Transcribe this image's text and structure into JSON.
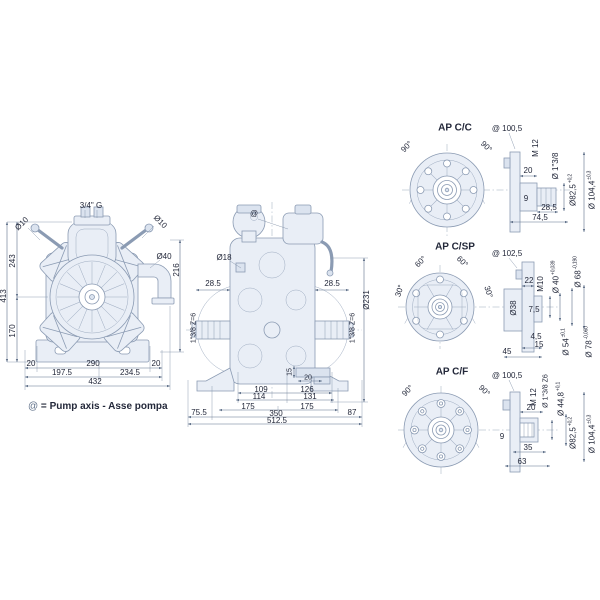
{
  "colors": {
    "line": "#8b9bb3",
    "dim": "#5f7089",
    "fill": "#e9eef6",
    "text": "#23283a"
  },
  "legend": {
    "symbol": "@",
    "equals": " = ",
    "text": "Pump axis - Asse pompa"
  },
  "front_view": {
    "labels": [
      {
        "t": "3/4\" G",
        "x": 91,
        "y": 206
      },
      {
        "t": "Ø10",
        "x": 22,
        "y": 224,
        "r": -45
      },
      {
        "t": "Ø10",
        "x": 160,
        "y": 222,
        "r": 45
      },
      {
        "t": "Ø40",
        "x": 164,
        "y": 257
      },
      {
        "t": "216",
        "x": 177,
        "y": 270,
        "r": -90
      },
      {
        "t": "413",
        "x": 4,
        "y": 296,
        "r": -90
      },
      {
        "t": "243",
        "x": 13,
        "y": 261,
        "r": -90
      },
      {
        "t": "170",
        "x": 13,
        "y": 331,
        "r": -90
      },
      {
        "t": "20",
        "x": 31,
        "y": 364
      },
      {
        "t": "290",
        "x": 93,
        "y": 364
      },
      {
        "t": "20",
        "x": 156,
        "y": 364
      },
      {
        "t": "197.5",
        "x": 62,
        "y": 373
      },
      {
        "t": "234.5",
        "x": 130,
        "y": 373
      },
      {
        "t": "432",
        "x": 95,
        "y": 382
      }
    ]
  },
  "side_view": {
    "labels": [
      {
        "t": "@",
        "x": 254,
        "y": 214
      },
      {
        "t": "Ø18",
        "x": 224,
        "y": 258
      },
      {
        "t": "28.5",
        "x": 213,
        "y": 284
      },
      {
        "t": "28.5",
        "x": 332,
        "y": 284
      },
      {
        "t": "Ø231",
        "x": 367,
        "y": 300,
        "r": -90
      },
      {
        "t": "1\"3/8 Z=6",
        "x": 194,
        "y": 328,
        "r": -90,
        "s": 7
      },
      {
        "t": "1\"3/8 Z=6",
        "x": 353,
        "y": 328,
        "r": -90,
        "s": 7
      },
      {
        "t": "15",
        "x": 290,
        "y": 372,
        "r": -90,
        "s": 7
      },
      {
        "t": "20",
        "x": 308,
        "y": 378,
        "s": 7
      },
      {
        "t": "109",
        "x": 261,
        "y": 390
      },
      {
        "t": "126",
        "x": 307,
        "y": 390
      },
      {
        "t": "114",
        "x": 259,
        "y": 397
      },
      {
        "t": "131",
        "x": 310,
        "y": 397
      },
      {
        "t": "175",
        "x": 248,
        "y": 407
      },
      {
        "t": "175",
        "x": 307,
        "y": 407
      },
      {
        "t": "75.5",
        "x": 199,
        "y": 413
      },
      {
        "t": "350",
        "x": 276,
        "y": 414
      },
      {
        "t": "87",
        "x": 352,
        "y": 413
      },
      {
        "t": "512.5",
        "x": 277,
        "y": 421
      }
    ]
  },
  "flanges": [
    {
      "title": "AP C/C",
      "labels": [
        {
          "t": "90°",
          "x": 407,
          "y": 147,
          "r": -45
        },
        {
          "t": "90°",
          "x": 486,
          "y": 147,
          "r": 45
        },
        {
          "t": "@ 100,5",
          "x": 507,
          "y": 129
        },
        {
          "t": "M 12",
          "x": 536,
          "y": 148,
          "r": -90
        },
        {
          "t": "20",
          "x": 528,
          "y": 171
        },
        {
          "t": "Ø 1\"3/8",
          "x": 556,
          "y": 166,
          "r": -90
        },
        {
          "t": "9",
          "x": 526,
          "y": 199
        },
        {
          "t": "Ø82,5",
          "tol": "+0,2",
          "x": 573,
          "y": 190,
          "r": -90
        },
        {
          "t": "Ø 104,4",
          "tol": "±0,3",
          "x": 592,
          "y": 190,
          "r": -90
        },
        {
          "t": "28,5",
          "x": 549,
          "y": 208
        },
        {
          "t": "74,5",
          "x": 540,
          "y": 218
        }
      ]
    },
    {
      "title": "AP C/SP",
      "labels": [
        {
          "t": "60°",
          "x": 421,
          "y": 262,
          "r": -45
        },
        {
          "t": "60°",
          "x": 462,
          "y": 262,
          "r": 45
        },
        {
          "t": "30°",
          "x": 400,
          "y": 291,
          "r": -72
        },
        {
          "t": "30°",
          "x": 488,
          "y": 292,
          "r": 72
        },
        {
          "t": "@ 102,5",
          "x": 507,
          "y": 254
        },
        {
          "t": "22",
          "x": 529,
          "y": 281
        },
        {
          "t": "M10",
          "x": 541,
          "y": 284,
          "r": -90
        },
        {
          "t": "Ø 40",
          "tol": "+0,039",
          "x": 556,
          "y": 277,
          "r": -90
        },
        {
          "t": "Ø 68",
          "tol": "-0,190",
          "x": 578,
          "y": 272,
          "r": -90
        },
        {
          "t": "Ø38",
          "x": 514,
          "y": 308,
          "r": -90
        },
        {
          "t": "7,5",
          "x": 534,
          "y": 310
        },
        {
          "t": "4,5",
          "x": 536,
          "y": 337
        },
        {
          "t": "15",
          "x": 539,
          "y": 345
        },
        {
          "t": "45",
          "x": 507,
          "y": 352
        },
        {
          "t": "Ø 54",
          "tol": "±0,1",
          "x": 566,
          "y": 342,
          "r": -90
        },
        {
          "t": "Ø 78",
          "tol": "-0,060",
          "x": 589,
          "y": 342,
          "r": -90
        }
      ]
    },
    {
      "title": "AP C/F",
      "labels": [
        {
          "t": "90°",
          "x": 408,
          "y": 391,
          "r": -45
        },
        {
          "t": "90°",
          "x": 484,
          "y": 391,
          "r": 45
        },
        {
          "t": "@ 100,5",
          "x": 507,
          "y": 376
        },
        {
          "t": "M 12",
          "x": 534,
          "y": 397,
          "r": -90
        },
        {
          "t": "Ø 1\"3/8 Z6",
          "x": 546,
          "y": 391,
          "r": -90,
          "s": 7
        },
        {
          "t": "Ø 44,8",
          "tol": "+0,1",
          "x": 561,
          "y": 399,
          "r": -90
        },
        {
          "t": "20",
          "x": 531,
          "y": 408
        },
        {
          "t": "9",
          "x": 502,
          "y": 437
        },
        {
          "t": "Ø82,5",
          "tol": "+0,2",
          "x": 573,
          "y": 433,
          "r": -90
        },
        {
          "t": "Ø 104,4",
          "tol": "±0,3",
          "x": 592,
          "y": 434,
          "r": -90
        },
        {
          "t": "35",
          "x": 528,
          "y": 448
        },
        {
          "t": "63",
          "x": 522,
          "y": 462
        }
      ]
    }
  ]
}
